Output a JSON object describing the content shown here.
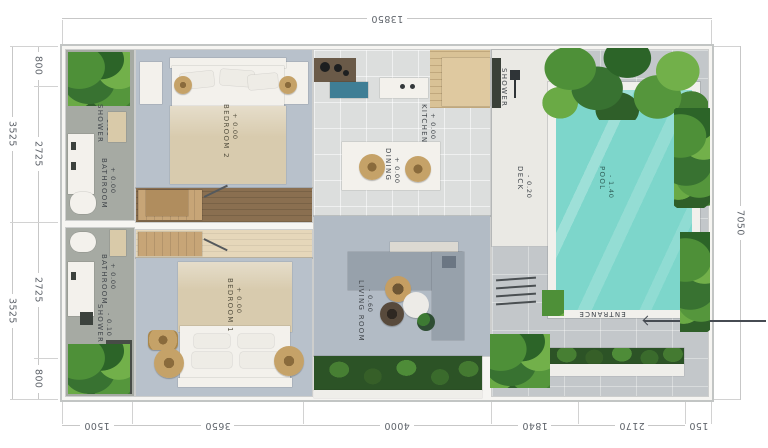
{
  "dims": {
    "top": [
      "13850"
    ],
    "bottom": [
      "1500",
      "3650",
      "4000",
      "1840",
      "2170",
      "150"
    ],
    "left_outer": [
      "3525",
      "3525"
    ],
    "left_inner": [
      "800",
      "2725",
      "2725",
      "800"
    ],
    "right": [
      "7050"
    ]
  },
  "labels": {
    "shower_top": {
      "name": "SHOWER",
      "level": "- 0.10"
    },
    "bathroom_top": {
      "name": "BATHROOM",
      "level": "+ 0.00"
    },
    "bedroom2": {
      "name": "BEDROOM 2",
      "level": "+ 0.00"
    },
    "bathroom_bottom": {
      "name": "BATHROOM",
      "level": "+ 0.00"
    },
    "shower_bottom": {
      "name": "SHOWER",
      "level": "- 0.10"
    },
    "bedroom1": {
      "name": "BEDROOM 1",
      "level": "+ 0.00"
    },
    "kitchen": {
      "name": "KITCHEN",
      "level": "+ 0.00"
    },
    "dining": {
      "name": "DINING",
      "level": "+ 0.00"
    },
    "living_room": {
      "name": "LIVING ROOM",
      "level": "- 0.60"
    },
    "deck": {
      "name": "DECK",
      "level": "- 0.20"
    },
    "outdoor_shower": {
      "name": "SHOWER",
      "level": ""
    },
    "pool": {
      "name": "POOL",
      "level": "- 1.40"
    },
    "entrance": {
      "name": "ENTRANCE"
    }
  },
  "colors": {
    "pool_water": "#7dd6cb",
    "foliage_green": "#4e9038",
    "bedroom_floor": "#b8c1cb",
    "bathroom_floor": "#a6aaa3",
    "living_floor": "#b2bbc5",
    "deck_white": "#eae9e4",
    "stone_gray": "#c3c7ca",
    "wood": "#c7a577",
    "dim_text": "#5f646b",
    "label_text": "#41464b"
  }
}
